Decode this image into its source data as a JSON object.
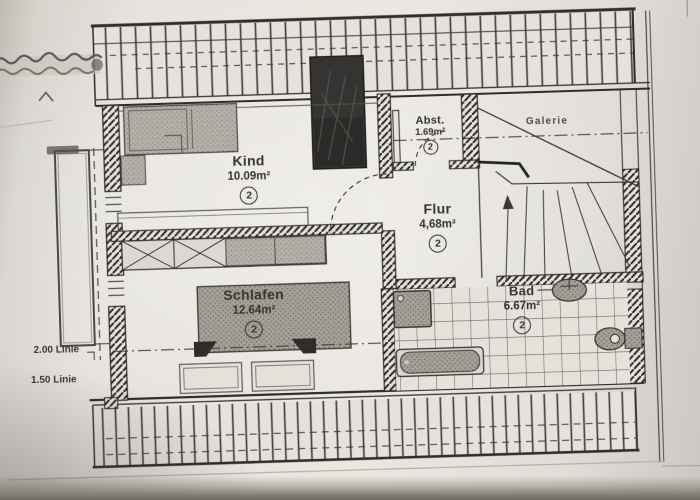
{
  "plan": {
    "rooms": [
      {
        "name": "Kind",
        "area": "10.09m²",
        "level": "2"
      },
      {
        "name": "Schlafen",
        "area": "12.64m²",
        "level": "2"
      },
      {
        "name": "Flur",
        "area": "4,68m²",
        "level": "2"
      },
      {
        "name": "Abst.",
        "area": "1.69m²",
        "level": "2"
      },
      {
        "name": "Bad",
        "area": "6.67m²",
        "level": "2"
      }
    ],
    "galerie_label": "Galerie",
    "height_lines": {
      "line_200": "2.00 Linie",
      "line_150": "1.50 Linie"
    }
  },
  "colors": {
    "paper": "#e9e6e0",
    "ink": "#2e2c28",
    "wall_fill": "#2b2925",
    "furniture_gray": "#b5b1aa",
    "photo_shadow": "#6e6b63"
  }
}
